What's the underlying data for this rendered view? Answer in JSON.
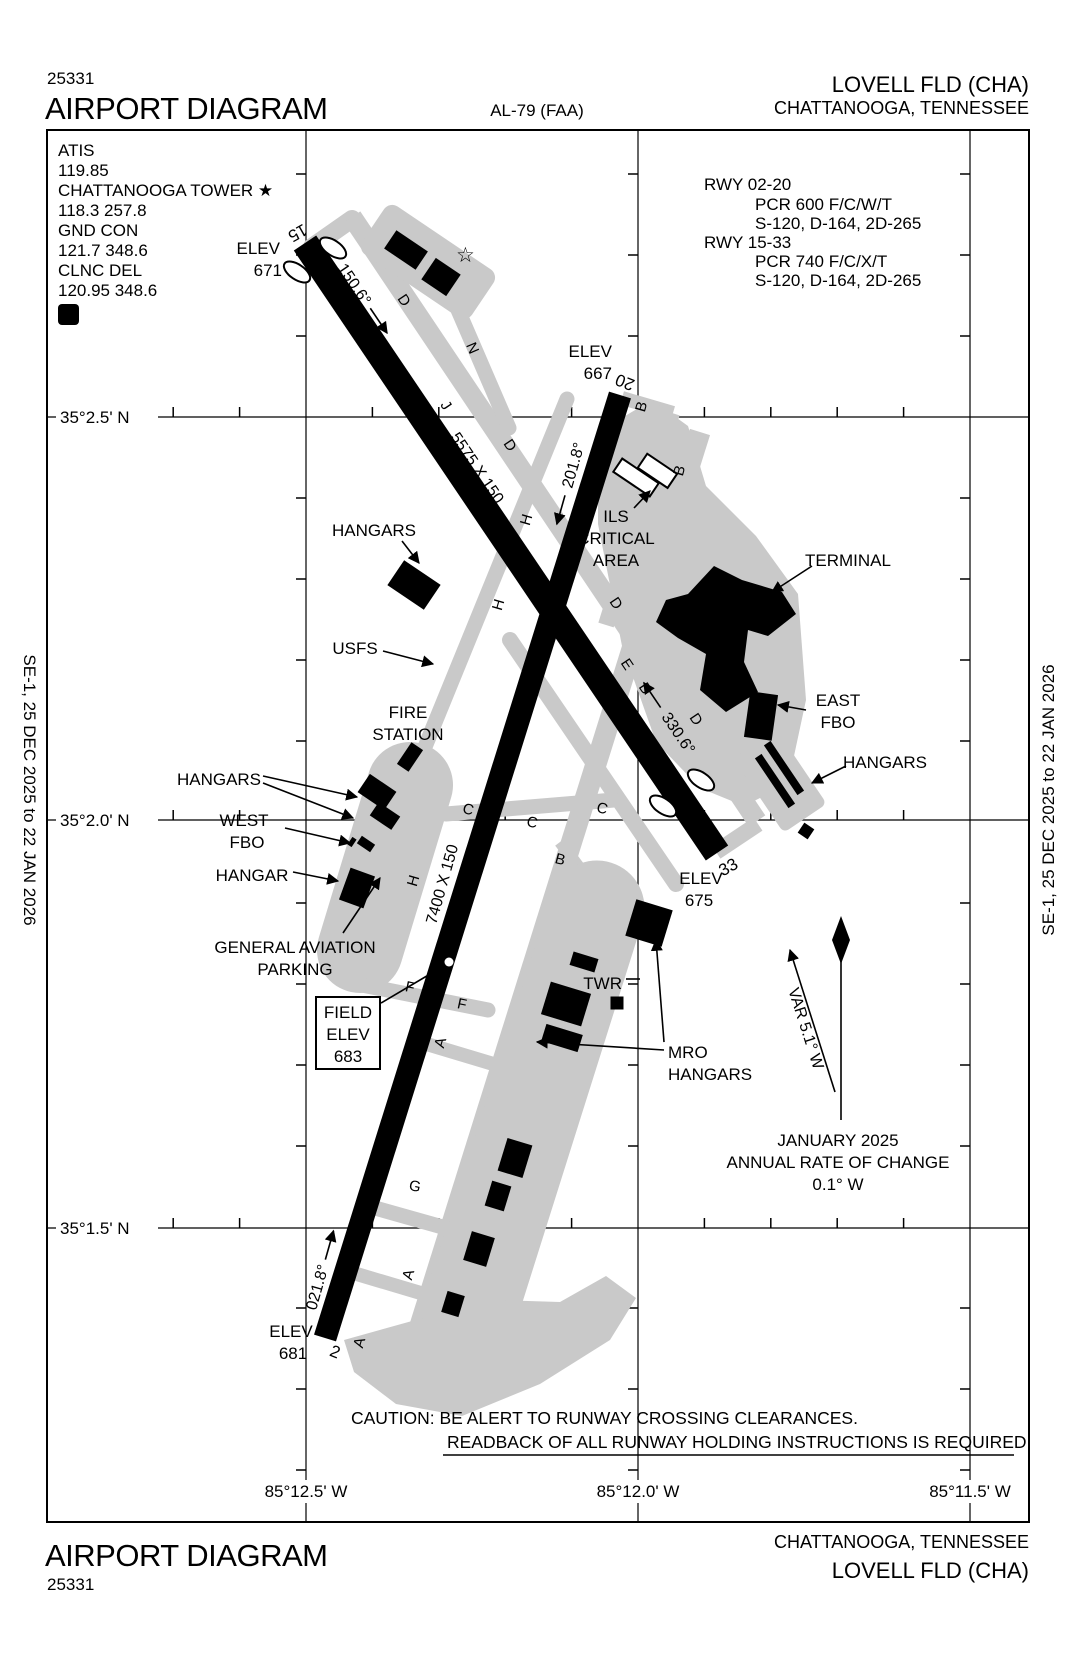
{
  "header": {
    "chart_code": "25331",
    "title": "AIRPORT DIAGRAM",
    "chart_ref": "AL-79 (FAA)",
    "airport": "LOVELL FLD  (CHA)",
    "city": "CHATTANOOGA, TENNESSEE"
  },
  "sidebars": {
    "left": "SE-1,  25 DEC 2025  to  22 JAN 2026",
    "right": "SE-1,  25 DEC 2025  to  22 JAN 2026"
  },
  "comm": {
    "l1": "ATIS",
    "l2": "119.85",
    "l3": "CHATTANOOGA TOWER ★",
    "l4": "118.3  257.8",
    "l5": "GND CON",
    "l6": "121.7  348.6",
    "l7": "CLNC DEL",
    "l8": "120.95  348.6",
    "datis": "D"
  },
  "rwyinfo": {
    "r1": "RWY 02-20",
    "r1a": "PCR 600 F/C/W/T",
    "r1b": "S-120, D-164, 2D-265",
    "r2": "RWY 15-33",
    "r2a": "PCR 740 F/C/X/T",
    "r2b": "S-120, D-164, 2D-265"
  },
  "grid": {
    "lat1": "35°2.5' N",
    "lat2": "35°2.0' N",
    "lat3": "35°1.5' N",
    "lon1": "85°12.5' W",
    "lon2": "85°12.0' W",
    "lon3": "85°11.5' W"
  },
  "runways": {
    "rw15": "15",
    "rw33": "33",
    "rw2": "2",
    "rw20": "20",
    "hdg15": "150.6°",
    "hdg33": "330.6°",
    "hdg2": "021.8°",
    "hdg20": "201.8°",
    "dim1533": "5575 X 150",
    "dim0220": "7400 X 150",
    "elev15a": "ELEV",
    "elev15b": "671",
    "elev20a": "ELEV",
    "elev20b": "667",
    "elev33a": "ELEV",
    "elev33b": "675",
    "elev2a": "ELEV",
    "elev2b": "681"
  },
  "fieldelev": {
    "l1": "FIELD",
    "l2": "ELEV",
    "l3": "683"
  },
  "labels": {
    "hangars_nw": "HANGARS",
    "usfs": "USFS",
    "fire1": "FIRE",
    "fire2": "STATION",
    "hangars_w": "HANGARS",
    "westfbo1": "WEST",
    "westfbo2": "FBO",
    "hangar": "HANGAR",
    "ga1": "GENERAL AVIATION",
    "ga2": "PARKING",
    "terminal": "TERMINAL",
    "eastfbo1": "EAST",
    "eastfbo2": "FBO",
    "hangars_e": "HANGARS",
    "ils1": "ILS",
    "ils2": "CRITICAL",
    "ils3": "AREA",
    "twr": "TWR",
    "mro1": "MRO",
    "mro2": "HANGARS"
  },
  "north": {
    "var": "VAR 5.1° W",
    "l1": "JANUARY 2025",
    "l2": "ANNUAL RATE OF CHANGE",
    "l3": "0.1° W"
  },
  "caution": {
    "l1": "CAUTION: BE ALERT TO RUNWAY CROSSING CLEARANCES.",
    "l2": "READBACK OF ALL RUNWAY HOLDING INSTRUCTIONS IS REQUIRED."
  },
  "footer": {
    "title": "AIRPORT DIAGRAM",
    "chart_code": "25331",
    "city": "CHATTANOOGA, TENNESSEE",
    "airport": "LOVELL FLD  (CHA)"
  },
  "tw": {
    "n": "N",
    "j": "J",
    "d1": "D",
    "d2": "D",
    "d3": "D",
    "d4": "D",
    "b1": "B",
    "b2": "B",
    "b3": "B",
    "b4": "B",
    "e": "E",
    "h1": "H",
    "h2": "H",
    "h3": "H",
    "c1": "C",
    "c2": "C",
    "c3": "C",
    "f1": "F",
    "f2": "F",
    "g": "G",
    "a1": "A",
    "a2": "A",
    "a3": "A"
  },
  "symbols": {
    "beacon": "☆"
  },
  "colors": {
    "pavement": "#c9c9c9",
    "runway": "#000000",
    "background": "#ffffff"
  }
}
